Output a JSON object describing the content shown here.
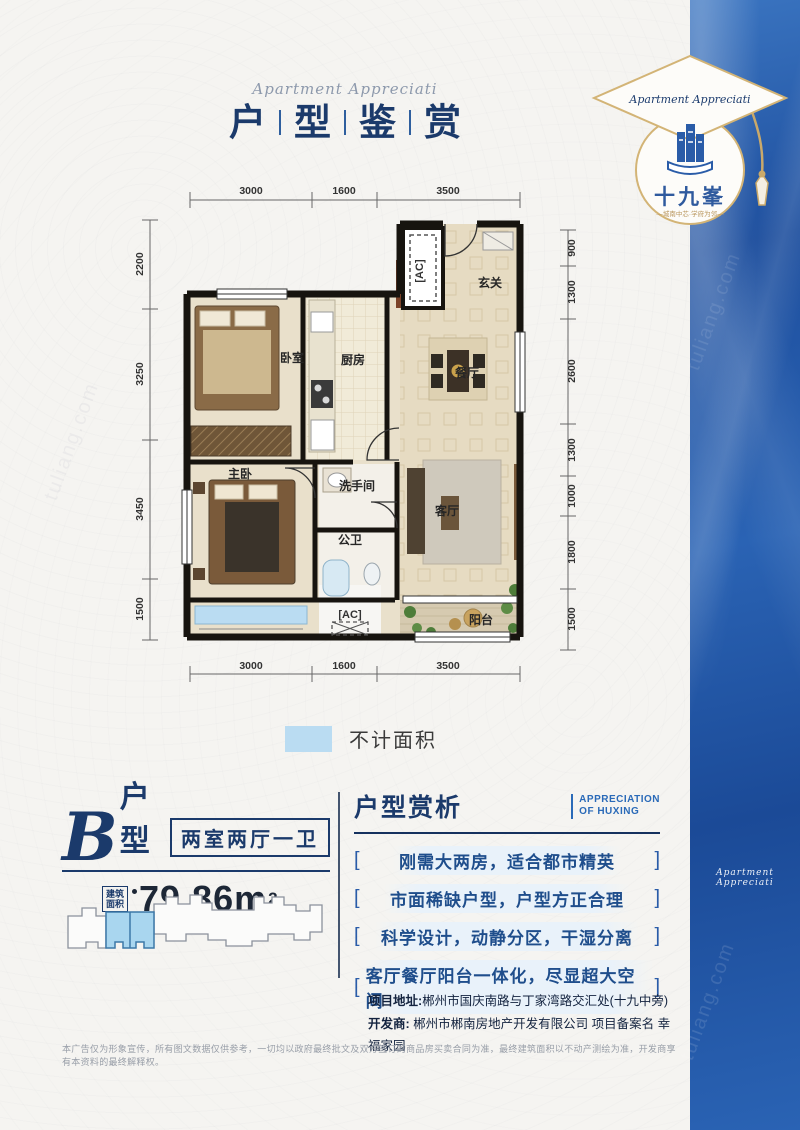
{
  "title": {
    "script": "Apartment Appreciati",
    "chars": [
      "户",
      "型",
      "鉴",
      "赏"
    ]
  },
  "logo": {
    "script": "Apartment Appreciati",
    "name": "十九峯",
    "tagline": "—城南中芯·学府为邻—"
  },
  "sidebar": {
    "vertical_text": "城南中芯·学府为邻",
    "script": "Apartment Appreciati"
  },
  "watermark": "tuliang.com",
  "floorplan": {
    "dims_top": [
      "3000",
      "1600",
      "3500"
    ],
    "dims_bottom": [
      "3000",
      "1600",
      "3500"
    ],
    "dims_left": [
      "2200",
      "3250",
      "3450",
      "1500"
    ],
    "dims_right": [
      "900",
      "1300",
      "2600",
      "1300",
      "1000",
      "1800",
      "1500"
    ],
    "rooms": {
      "bedroom": "卧室",
      "kitchen": "厨房",
      "dining": "餐厅",
      "entry": "玄关",
      "master": "主卧",
      "washroom": "洗手间",
      "bath": "公卫",
      "living": "客厅",
      "balcony": "阳台"
    },
    "ac_label": "[AC]"
  },
  "legend": {
    "label": "不计面积",
    "color": "#badcf2"
  },
  "unit": {
    "letter": "B",
    "suffix": "户型",
    "layout": "两室两厅一卫",
    "area_label_line1": "建筑",
    "area_label_line2": "面积",
    "area_value": "79.86m",
    "area_sup": "2"
  },
  "analysis": {
    "title": "户型赏析",
    "subtitle_line1": "APPRECIATION",
    "subtitle_line2": "OF HUXING",
    "bracket_l": "[",
    "bracket_r": "]",
    "points": [
      "刚需大两房，适合都市精英",
      "市面稀缺户型，户型方正合理",
      "科学设计，动静分区，干湿分离",
      "客厅餐厅阳台一体化，尽显超大空间"
    ]
  },
  "info": {
    "address_label": "项目地址:",
    "address": "郴州市国庆南路与丁家湾路交汇处(十九中旁)",
    "developer_label": "开发商:",
    "developer": "郴州市郴南房地产开发有限公司 项目备案名 幸福家园"
  },
  "disclaimer": "本广告仅为形象宣传，所有图文数据仅供参考，一切均以政府最终批文及双方签订的商品房买卖合同为准，最终建筑面积以不动产测绘为准，开发商享有本资料的最终解释权。",
  "colors": {
    "navy": "#1b3a6b",
    "accent_blue": "#2a5ca8",
    "sidebar_blue": "#2462b2",
    "gold": "#d9bd7f",
    "legend_blue": "#badcf2",
    "wall": "#17140f"
  }
}
